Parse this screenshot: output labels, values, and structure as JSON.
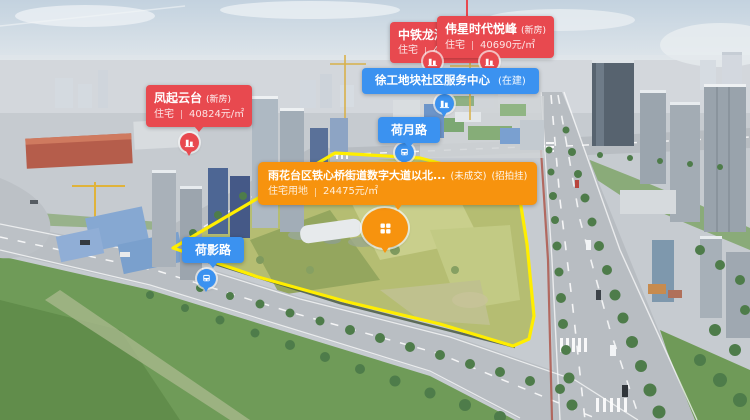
{
  "colors": {
    "residential_label": "#e8494f",
    "facility_label": "#3b92f0",
    "land_label": "#f7930e",
    "plot_outline": "#ffee00"
  },
  "markers": {
    "fengqi": {
      "title": "凤起云台",
      "tag": "(新房)",
      "category": "住宅",
      "price": "40824元/㎡"
    },
    "zhongtie": {
      "title": "中铁龙湖·",
      "category": "住宅",
      "price": "4"
    },
    "weixing": {
      "title": "伟星时代悦峰",
      "tag": "(新房)",
      "category": "住宅",
      "price": "40690元/㎡"
    },
    "xugong": {
      "title": "徐工地块社区服务中心",
      "tag": "(在建)"
    },
    "land": {
      "title": "雨花台区铁心桥街道数字大道以北...",
      "status": "(未成交)",
      "listing_type": "(招拍挂)",
      "category": "住宅用地",
      "price": "24475元/㎡"
    },
    "road_heyue": {
      "name": "荷月路"
    },
    "road_heying": {
      "name": "荷影路"
    }
  }
}
